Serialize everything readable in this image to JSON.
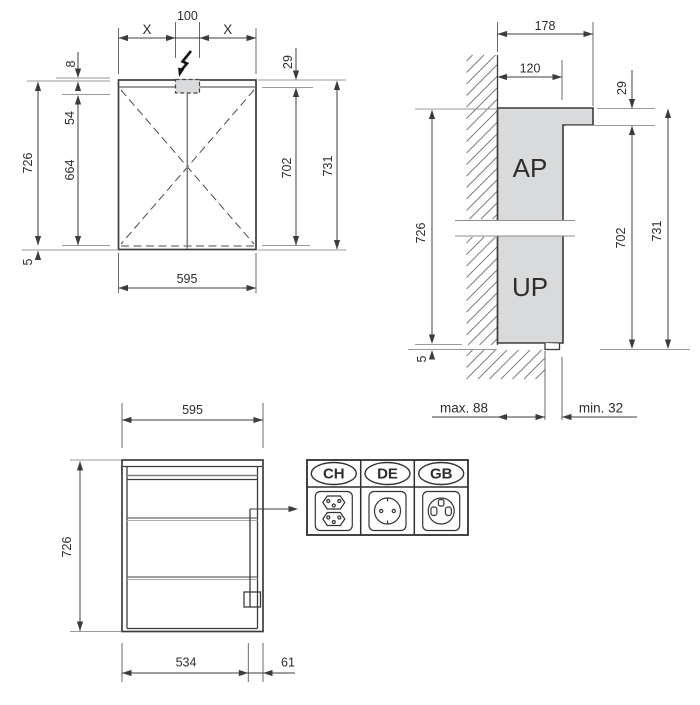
{
  "drawing": {
    "front_view": {
      "top": {
        "x_left": "X",
        "center_100": "100",
        "x_right": "X"
      },
      "left": {
        "d8": "8",
        "d54": "54",
        "d664": "664",
        "d726": "726",
        "d5": "5"
      },
      "right": {
        "d29": "29",
        "d702": "702",
        "d731": "731"
      },
      "bottom": {
        "d595": "595"
      }
    },
    "side_view": {
      "top": {
        "d178": "178",
        "d120": "120"
      },
      "right": {
        "d29": "29",
        "d702": "702",
        "d731": "731"
      },
      "left": {
        "d726": "726",
        "d5": "5"
      },
      "bottom": {
        "max88": "max. 88",
        "min32": "min. 32"
      },
      "mount_labels": {
        "surface": "AP",
        "flush": "UP"
      }
    },
    "open_view": {
      "top": {
        "d595": "595"
      },
      "left": {
        "d726": "726"
      },
      "bottom": {
        "d534": "534",
        "d61": "61"
      }
    },
    "socket_panel": {
      "columns": [
        {
          "label": "CH",
          "icon": "swiss-socket-icon"
        },
        {
          "label": "DE",
          "icon": "schuko-socket-icon"
        },
        {
          "label": "GB",
          "icon": "uk-socket-icon"
        }
      ]
    },
    "colors": {
      "line": "#3c3c3c",
      "ref_line": "#9a9a9a",
      "fill_gray": "#d9dadb",
      "background": "#ffffff"
    }
  }
}
